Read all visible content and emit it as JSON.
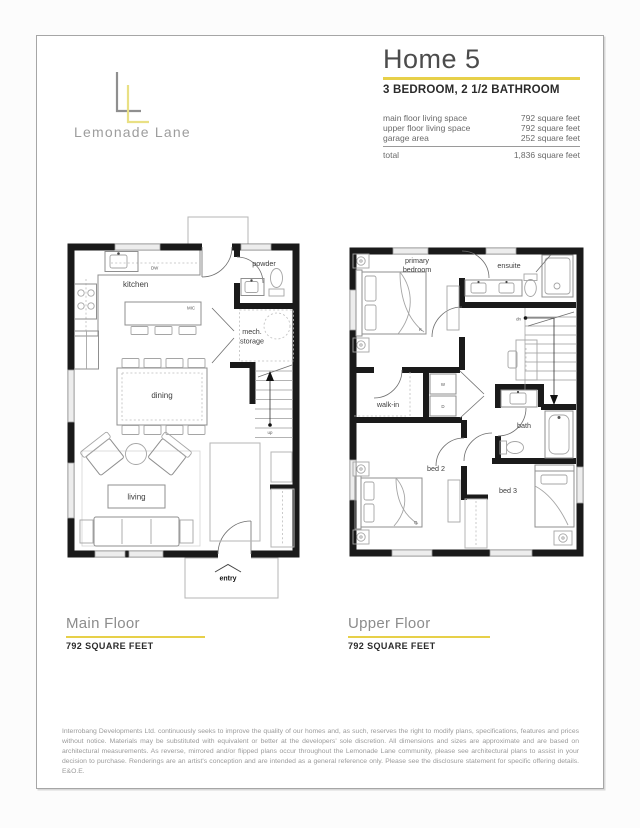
{
  "logo": {
    "brand": "Lemonade Lane"
  },
  "header": {
    "title": "Home 5",
    "subtitle": "3 BEDROOM, 2 1/2 BATHROOM",
    "rows": [
      {
        "label": "main floor living space",
        "value": "792 square feet"
      },
      {
        "label": "upper floor living space",
        "value": "792 square feet"
      },
      {
        "label": "garage area",
        "value": "252 square feet"
      }
    ],
    "total_label": "total",
    "total_value": "1,836 square feet"
  },
  "main_floor": {
    "title": "Main Floor",
    "area": "792 SQUARE FEET",
    "labels": {
      "kitchen": "kitchen",
      "dining": "dining",
      "living": "living",
      "powder": "powder",
      "mech_line1": "mech.",
      "mech_line2": "storage",
      "entry": "entry",
      "up": "up",
      "dw": "DW",
      "mic": "MIC"
    }
  },
  "upper_floor": {
    "title": "Upper Floor",
    "area": "792 SQUARE FEET",
    "labels": {
      "primary_line1": "primary",
      "primary_line2": "bedroom",
      "ensuite": "ensuite",
      "walk_in": "walk-in",
      "bath": "bath",
      "bed2": "bed 2",
      "bed3": "bed 3",
      "dn": "dn",
      "washer": "W",
      "dryer": "D",
      "king": "K",
      "queen": "Q"
    }
  },
  "footer": {
    "disclaimer": "Interrobang Developments Ltd. continuously seeks to improve the quality of our homes and, as such, reserves the right to modify plans, specifications, features and prices without notice. Materials may be substituted with equivalent or better at the developers' sole discretion. All dimensions and sizes are approximate and are based on architectural measurements. As reverse, mirrored and/or flipped plans occur throughout the Lemonade Lane community, please see architectural plans to assist in your decision to purchase. Renderings are an artist's conception and are intended as a general reference only. Please see the disclosure statement for specific offering details. E&O.E."
  },
  "colors": {
    "accent_yellow": "#e7d049",
    "logo_yellow": "#e9e084",
    "logo_gray": "#8f8f8f",
    "wall_black": "#1a1a1a"
  }
}
